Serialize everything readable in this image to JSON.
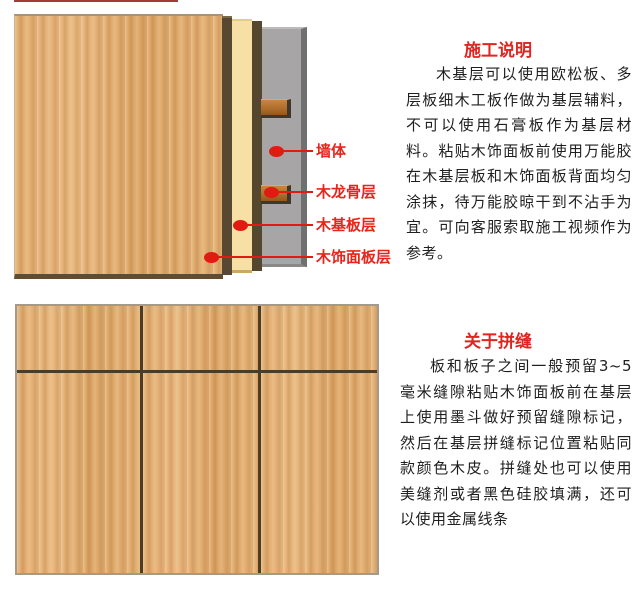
{
  "page": {
    "background_color": "#ffffff",
    "accent_red": "#e02420",
    "callout_red": "#df1b12"
  },
  "top_section": {
    "diagram": {
      "description": "exploded wall cross-section showing installation layers",
      "layers": [
        {
          "id": "wall",
          "label": "墙体",
          "color": "#a7a5a6"
        },
        {
          "id": "keel",
          "label": "木龙骨层",
          "color": "#b06e2c"
        },
        {
          "id": "base",
          "label": "木基板层",
          "color": "#f7e0a6"
        },
        {
          "id": "veneer",
          "label": "木饰面板层",
          "color": "#e2ad70"
        }
      ]
    },
    "title": "施工说明",
    "body": "木基层可以使用欧松板、多层板细木工板作做为基层辅料，不可以使用石膏板作为基层材料。粘贴木饰面板前使用万能胶在木基层板和木饰面板背面均匀涂抹，待万能胶晾干到不沾手为宜。可向客服索取施工视频作为参考。"
  },
  "bottom_section": {
    "title": "关于拼缝",
    "body": "板和板子之间一般预留3~5毫米缝隙粘贴木饰面板前在基层上使用墨斗做好预留缝隙标记，然后在基层拼缝标记位置粘贴同款颜色木皮。拼缝处也可以使用美缝剂或者黑色硅胶填满，还可以使用金属线条",
    "panel": {
      "columns": 3,
      "rows": 2,
      "gap_mm": "3~5",
      "seam_color": "#4c3b25"
    }
  }
}
